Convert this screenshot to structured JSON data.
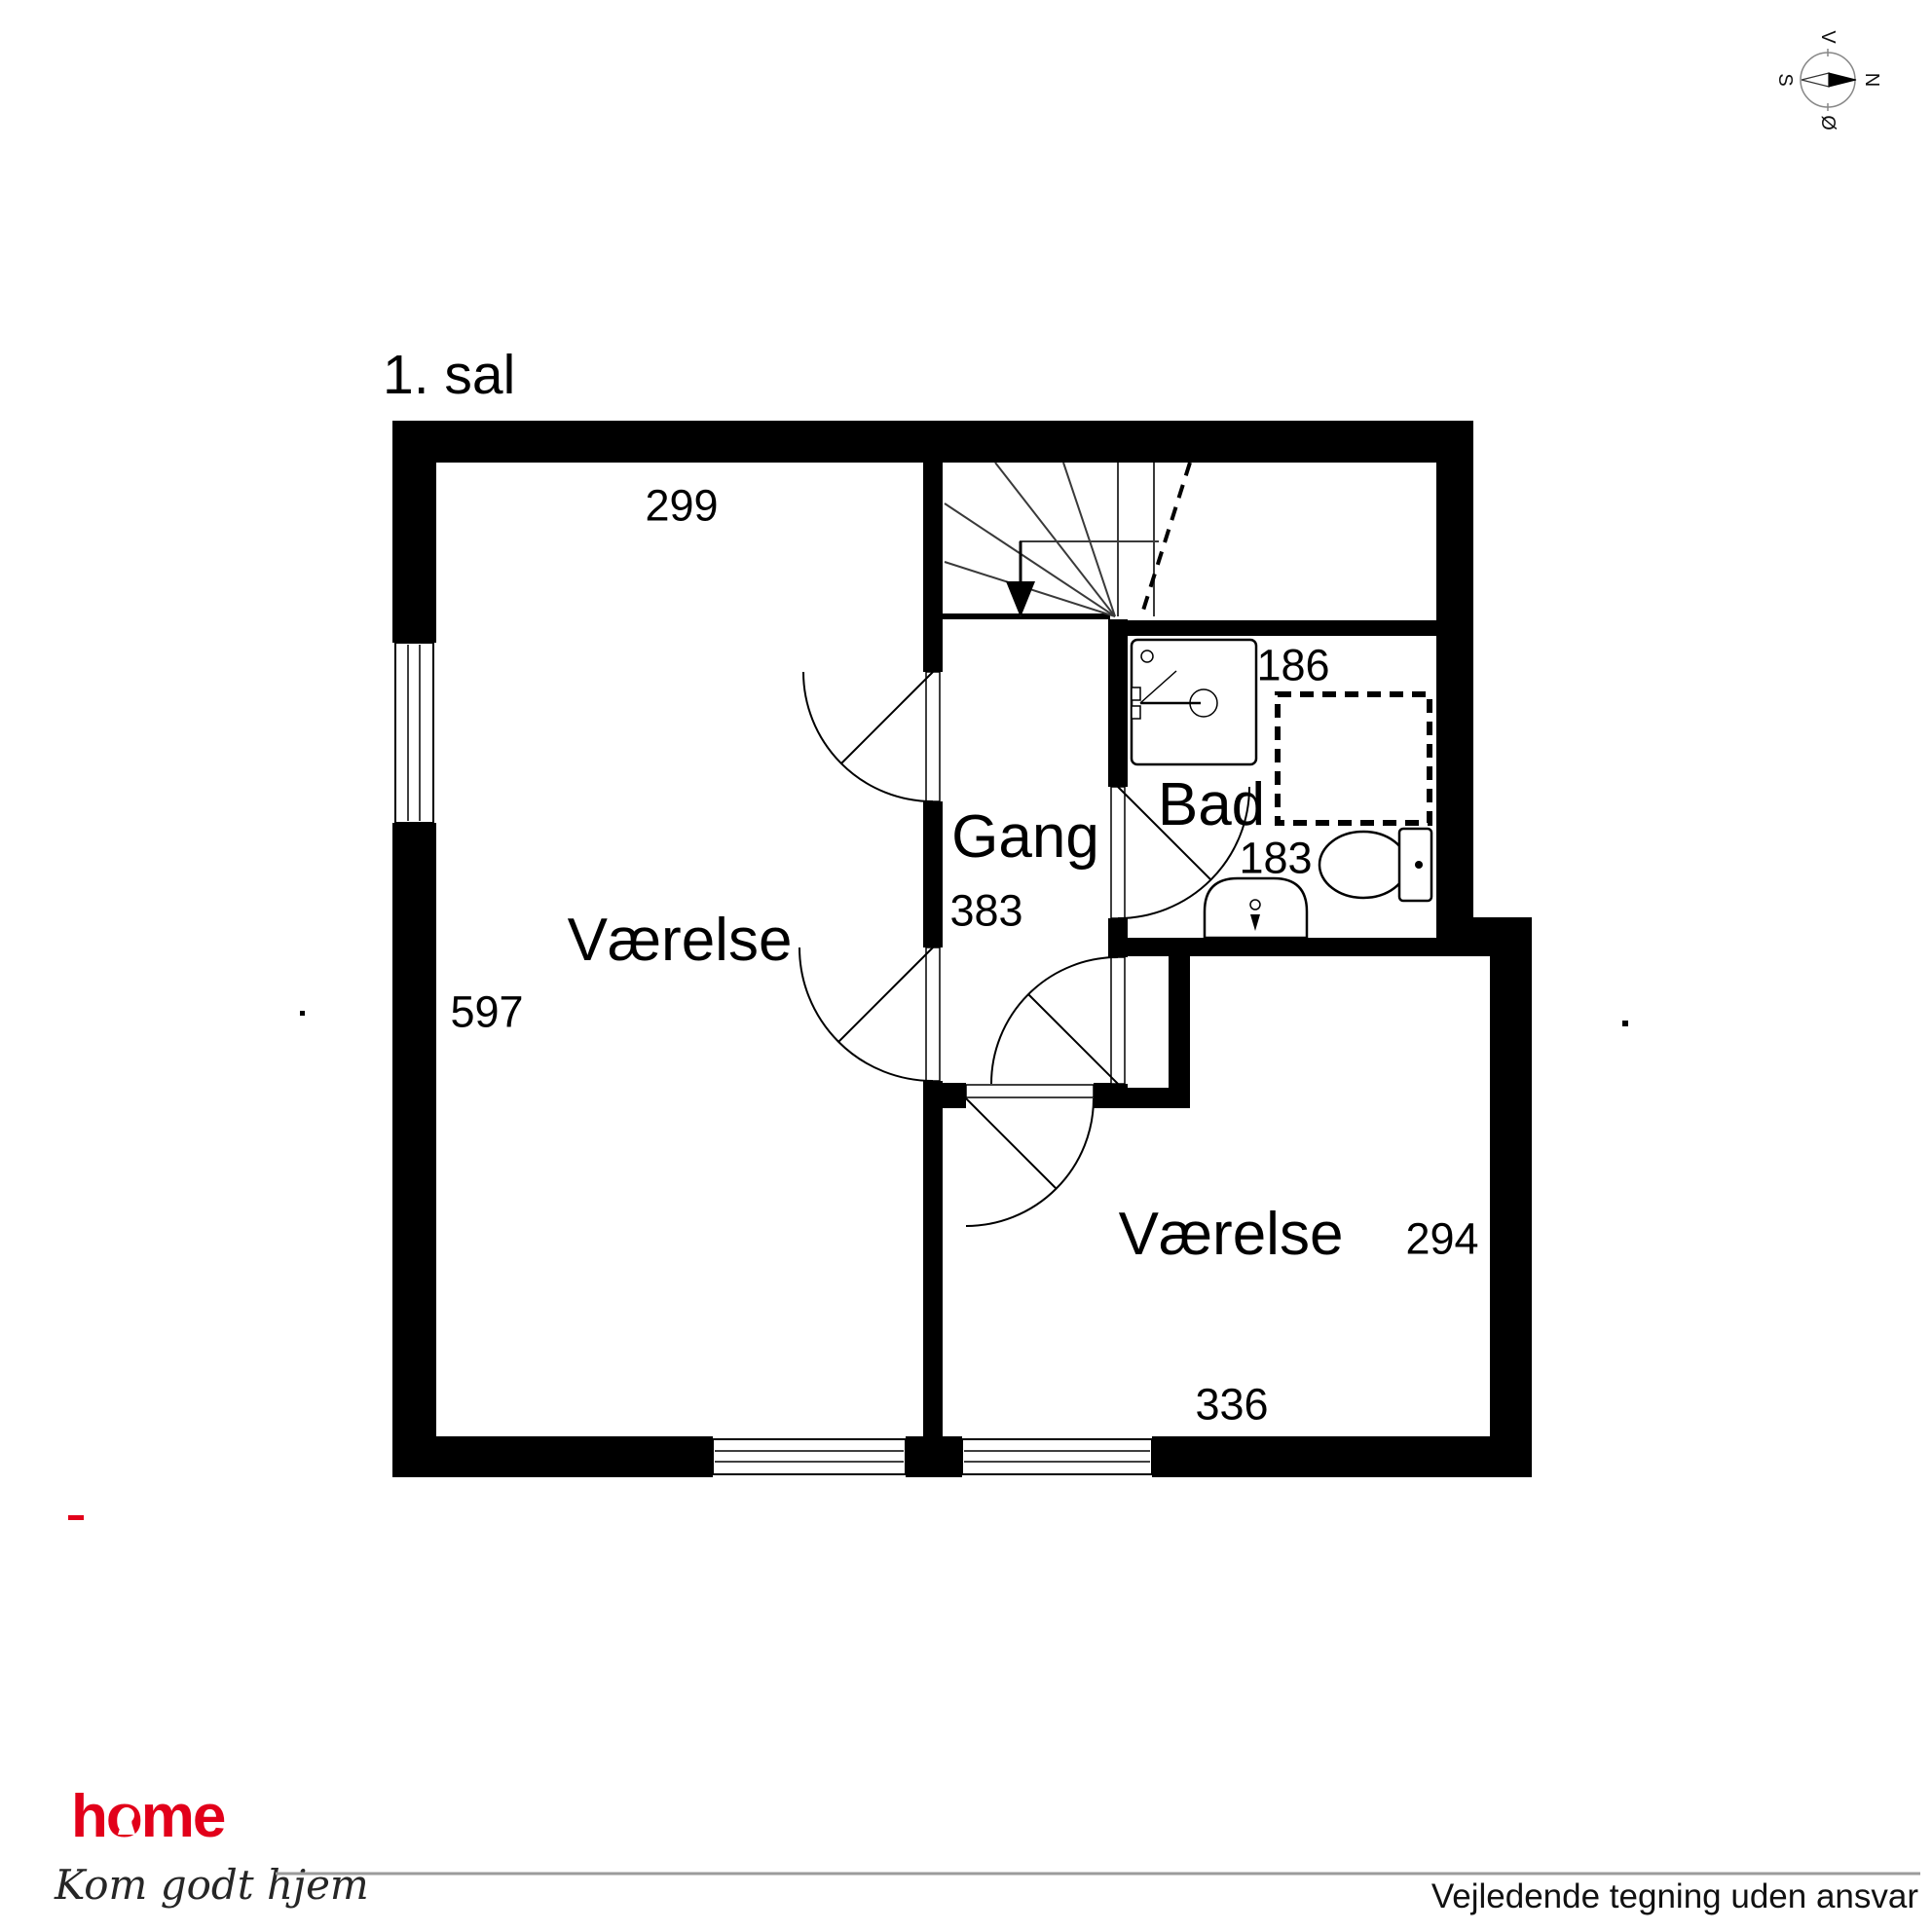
{
  "title": "1. sal",
  "rooms": [
    {
      "label": "Værelse",
      "width_label": "299",
      "height_label": "597"
    },
    {
      "label": "Gang",
      "length_label": "383"
    },
    {
      "label": "Bad",
      "width_label": "186",
      "length_label": "183"
    },
    {
      "label": "Værelse",
      "height_label": "294",
      "width_label": "336"
    }
  ],
  "compass": {
    "north": "N",
    "south": "S",
    "west": "V",
    "east": "Ø"
  },
  "brand": {
    "name": "home",
    "tagline": "Kom godt hjem",
    "color": "#e2001a"
  },
  "footer": {
    "disclaimer": "Vejledende tegning uden ansvar"
  },
  "colors": {
    "wall": "#000000",
    "background": "#ffffff",
    "rule": "#9b9b9b"
  }
}
